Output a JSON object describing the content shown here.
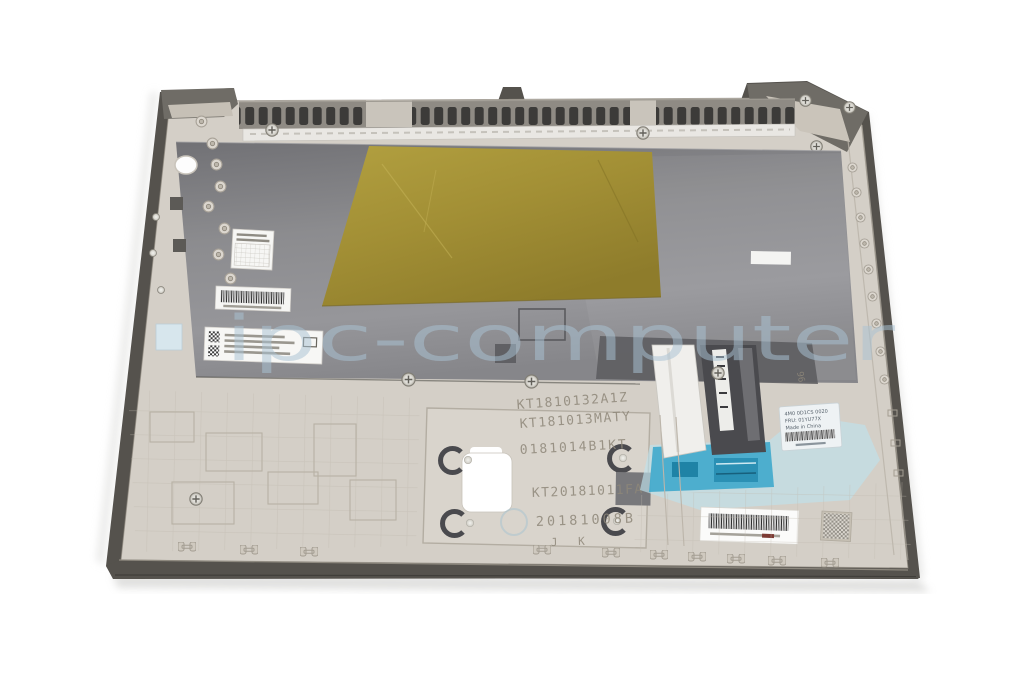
{
  "watermark": {
    "text": "ipc-computer",
    "color": "#aac3d4"
  },
  "stamps": [
    "KT1810132A1Z",
    "KT181013MATY",
    "0181014B1KT",
    "KT20181011FA",
    "20181008B",
    "J K",
    "96"
  ],
  "fru_label": {
    "line1": "4M0 0D1CS 0020",
    "line2": "FRU: 01YU77X",
    "line3": "Made in China"
  },
  "colors": {
    "background": "#ffffff",
    "rim_dark": "#55524d",
    "frame_beige": "#d4cfc7",
    "frame_rib": "#b3ac9f",
    "plate_gray": "#8c8c8f",
    "plate_dark": "#6f6f73",
    "gold_film": "#a28f35",
    "blue_film": "#bfe2ec",
    "blue_tape": "#3fa9cc",
    "label_white": "#f6f6f4",
    "watermark_blue": "#aac3d4"
  }
}
